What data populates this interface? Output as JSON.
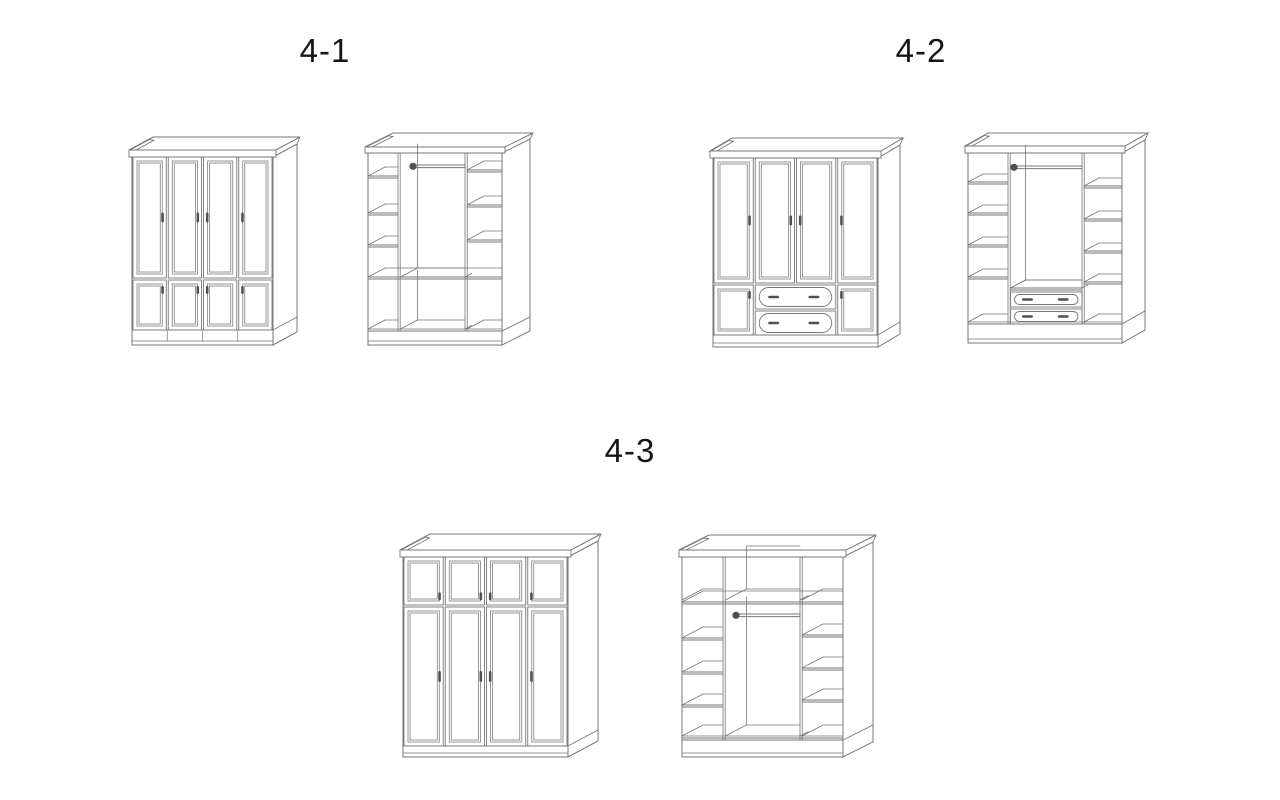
{
  "page": {
    "background": "#ffffff"
  },
  "figures": [
    {
      "id": "4-1",
      "label": "4-1",
      "views": [
        {
          "name": "wardrobe-4-doors-closed-front-icon"
        },
        {
          "name": "wardrobe-interior-shelves-hanging-rod-icon"
        }
      ]
    },
    {
      "id": "4-2",
      "label": "4-2",
      "views": [
        {
          "name": "wardrobe-4-doors-2-drawers-closed-front-icon"
        },
        {
          "name": "wardrobe-interior-shelves-rod-2-drawers-icon"
        }
      ]
    },
    {
      "id": "4-3",
      "label": "4-3",
      "views": [
        {
          "name": "wardrobe-top-cabinets-4-doors-closed-front-icon"
        },
        {
          "name": "wardrobe-interior-top-shelf-rod-shelves-icon"
        }
      ]
    }
  ],
  "colors": {
    "line": "#74777a",
    "dark_accent": "#4e5154",
    "text": "#161616",
    "background": "#ffffff"
  }
}
